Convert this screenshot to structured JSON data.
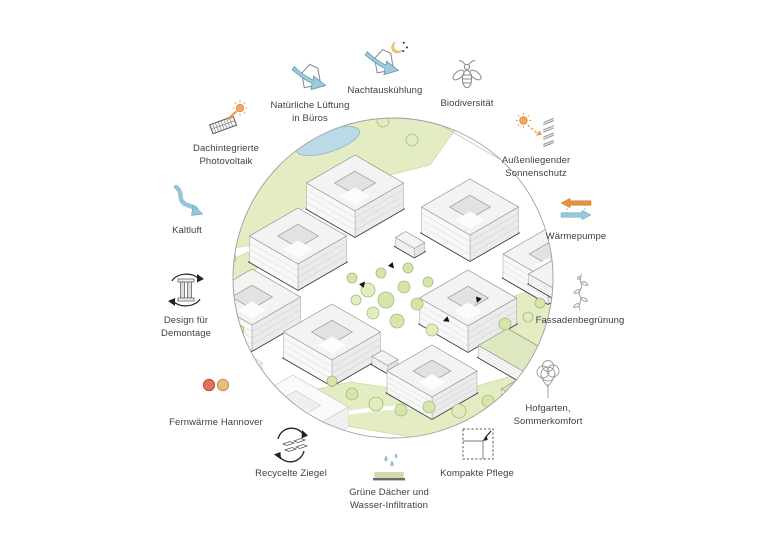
{
  "features": {
    "pv": {
      "label": "Dachintegrierte\nPhotovoltaik",
      "icon": "solar-panel-sun"
    },
    "natvent": {
      "label": "Natürliche Lüftung\nin Büros",
      "icon": "house-air-arrow"
    },
    "night": {
      "label": "Nachtauskühlung",
      "icon": "house-air-arrow-moon"
    },
    "bio": {
      "label": "Biodiversität",
      "icon": "bee"
    },
    "sunshade": {
      "label": "Außenliegender\nSonnenschutz",
      "icon": "sun-louvers"
    },
    "heatpump": {
      "label": "Wärmepumpe",
      "icon": "orange-blue-arrows"
    },
    "facade": {
      "label": "Fassadenbegrünung",
      "icon": "climbing-plant"
    },
    "hofgarten": {
      "label": "Hofgarten,\nSommerkomfort",
      "icon": "sketch-tree"
    },
    "compact": {
      "label": "Kompakte Pflege",
      "icon": "dashed-square-arrow"
    },
    "greenroof": {
      "label": "Grüne Dächer und\nWasser-Infiltration",
      "icon": "green-roof-drops"
    },
    "bricks": {
      "label": "Recycelte Ziegel",
      "icon": "bricks-recycle"
    },
    "fernw": {
      "label": "Fernwärme Hannover",
      "icon": "two-pipes"
    },
    "design": {
      "label": "Design für\nDemontage",
      "icon": "column-recycle"
    },
    "kaltluft": {
      "label": "Kaltluft",
      "icon": "cold-air-arrow"
    }
  },
  "accent_colors": {
    "blue": "#92c8da",
    "orange": "#e8923c",
    "red_pipe": "#e5705c",
    "tan_pipe": "#e9bd80",
    "moon": "#f0cf5e"
  },
  "illustration": {
    "circle": {
      "cx": 393,
      "cy": 278,
      "r": 160,
      "stroke": "#9e9e9e"
    },
    "colors": {
      "green": "#e3ecc3",
      "greenStroke": "#cbd7a0",
      "pond": "#bcd9e7",
      "pondStroke": "#8fb6c8",
      "roofGreen": "#dde8c0",
      "roofWhite": "#f3f3f1",
      "tree": "#d6e5a8",
      "tree2": "#e2ecbf",
      "treeStroke": "#a3bc7c",
      "faceSE": "#ebebeb",
      "faceSW": "#f8f8f8",
      "outline": "#161616"
    },
    "greens": [
      [
        [
          225,
          250
        ],
        [
          255,
          165
        ],
        [
          310,
          120
        ],
        [
          380,
          105
        ],
        [
          455,
          130
        ],
        [
          430,
          165
        ],
        [
          350,
          185
        ],
        [
          290,
          215
        ],
        [
          250,
          245
        ]
      ],
      [
        [
          470,
          310
        ],
        [
          540,
          288
        ],
        [
          595,
          320
        ],
        [
          560,
          365
        ],
        [
          490,
          345
        ]
      ],
      [
        [
          290,
          395
        ],
        [
          350,
          382
        ],
        [
          420,
          392
        ],
        [
          470,
          388
        ],
        [
          540,
          368
        ],
        [
          600,
          340
        ],
        [
          600,
          430
        ],
        [
          520,
          445
        ],
        [
          430,
          440
        ],
        [
          340,
          425
        ]
      ],
      [
        [
          228,
          262
        ],
        [
          248,
          252
        ],
        [
          258,
          268
        ],
        [
          236,
          278
        ]
      ]
    ],
    "pond": {
      "cx": 328,
      "cy": 141,
      "rx": 33,
      "ry": 11,
      "rot": -18
    },
    "roadLines": [
      [
        432,
        104,
        575,
        186
      ],
      [
        448,
        96,
        590,
        176
      ],
      [
        418,
        112,
        560,
        194
      ]
    ],
    "neighborRects": [
      {
        "x": 545,
        "y": 168,
        "w": 34,
        "h": 16
      },
      {
        "x": 505,
        "y": 140,
        "w": 26,
        "h": 13
      },
      {
        "x": 470,
        "y": 103,
        "w": 30,
        "h": 14
      }
    ],
    "cars": [
      {
        "x": 487,
        "y": 128
      },
      {
        "x": 520,
        "y": 147
      }
    ],
    "paths": [
      "M455,432 C500,420 545,414 585,392",
      "M320,420 C370,404 420,410 462,400",
      "M400,345 C420,365 440,380 465,398"
    ],
    "buildings": [
      {
        "cx": 355,
        "cy": 183,
        "a": 28,
        "b": 28,
        "h": 26,
        "court": 0.42
      },
      {
        "cx": 470,
        "cy": 207,
        "a": 28,
        "b": 28,
        "h": 26,
        "court": 0.42
      },
      {
        "cx": 298,
        "cy": 236,
        "a": 28,
        "b": 28,
        "h": 26,
        "court": 0.42
      },
      {
        "cx": 410,
        "cy": 240,
        "a": 11,
        "b": 6,
        "h": 9,
        "court": 0
      },
      {
        "cx": 548,
        "cy": 254,
        "a": 26,
        "b": 26,
        "h": 24,
        "court": 0.42
      },
      {
        "cx": 565,
        "cy": 281,
        "a": 28,
        "b": 14,
        "h": 10,
        "court": 0
      },
      {
        "cx": 252,
        "cy": 297,
        "a": 28,
        "b": 28,
        "h": 26,
        "court": 0.42
      },
      {
        "cx": 468,
        "cy": 298,
        "a": 28,
        "b": 28,
        "h": 26,
        "court": 0.42
      },
      {
        "cx": 519,
        "cy": 352,
        "a": 30,
        "b": 17,
        "h": 12,
        "court": 0,
        "roof": "green"
      },
      {
        "cx": 332,
        "cy": 332,
        "a": 28,
        "b": 28,
        "h": 26,
        "court": 0.42
      },
      {
        "cx": 385,
        "cy": 358,
        "a": 9,
        "b": 6,
        "h": 8,
        "court": 0
      },
      {
        "cx": 432,
        "cy": 371,
        "a": 26,
        "b": 26,
        "h": 22,
        "court": 0.42
      },
      {
        "cx": 543,
        "cy": 389,
        "a": 24,
        "b": 24,
        "h": 14,
        "court": 0.4,
        "roof": "green"
      },
      {
        "cx": 298,
        "cy": 404,
        "a": 32,
        "b": 26,
        "h": 20,
        "court": 0.45,
        "faint": true
      },
      {
        "cx": 233,
        "cy": 362,
        "a": 18,
        "b": 16,
        "h": 14,
        "court": 0,
        "faint": true
      }
    ],
    "trees": [
      [
        298,
        131,
        7
      ],
      [
        322,
        122,
        6
      ],
      [
        350,
        117,
        7
      ],
      [
        383,
        121,
        6
      ],
      [
        268,
        160,
        7
      ],
      [
        252,
        186,
        6
      ],
      [
        412,
        140,
        6
      ],
      [
        237,
        214,
        5
      ],
      [
        352,
        278,
        5
      ],
      [
        368,
        290,
        7
      ],
      [
        386,
        300,
        8
      ],
      [
        404,
        287,
        6
      ],
      [
        373,
        313,
        6
      ],
      [
        397,
        321,
        7
      ],
      [
        417,
        304,
        6
      ],
      [
        432,
        330,
        6
      ],
      [
        381,
        273,
        5
      ],
      [
        408,
        268,
        5
      ],
      [
        356,
        300,
        5
      ],
      [
        428,
        282,
        5
      ],
      [
        505,
        324,
        6
      ],
      [
        528,
        317,
        5
      ],
      [
        553,
        331,
        6
      ],
      [
        540,
        303,
        5
      ],
      [
        567,
        342,
        5
      ],
      [
        332,
        381,
        5
      ],
      [
        352,
        394,
        6
      ],
      [
        376,
        404,
        7
      ],
      [
        401,
        410,
        6
      ],
      [
        429,
        407,
        6
      ],
      [
        459,
        411,
        7
      ],
      [
        488,
        401,
        6
      ],
      [
        513,
        407,
        5
      ],
      [
        556,
        361,
        6
      ],
      [
        574,
        346,
        5
      ],
      [
        599,
        357,
        5
      ],
      [
        231,
        258,
        5
      ],
      [
        239,
        330,
        5
      ],
      [
        230,
        305,
        4
      ]
    ],
    "markers": [
      [
        392,
        266,
        140
      ],
      [
        363,
        284,
        40
      ],
      [
        446,
        320,
        250
      ],
      [
        478,
        300,
        200
      ]
    ]
  }
}
